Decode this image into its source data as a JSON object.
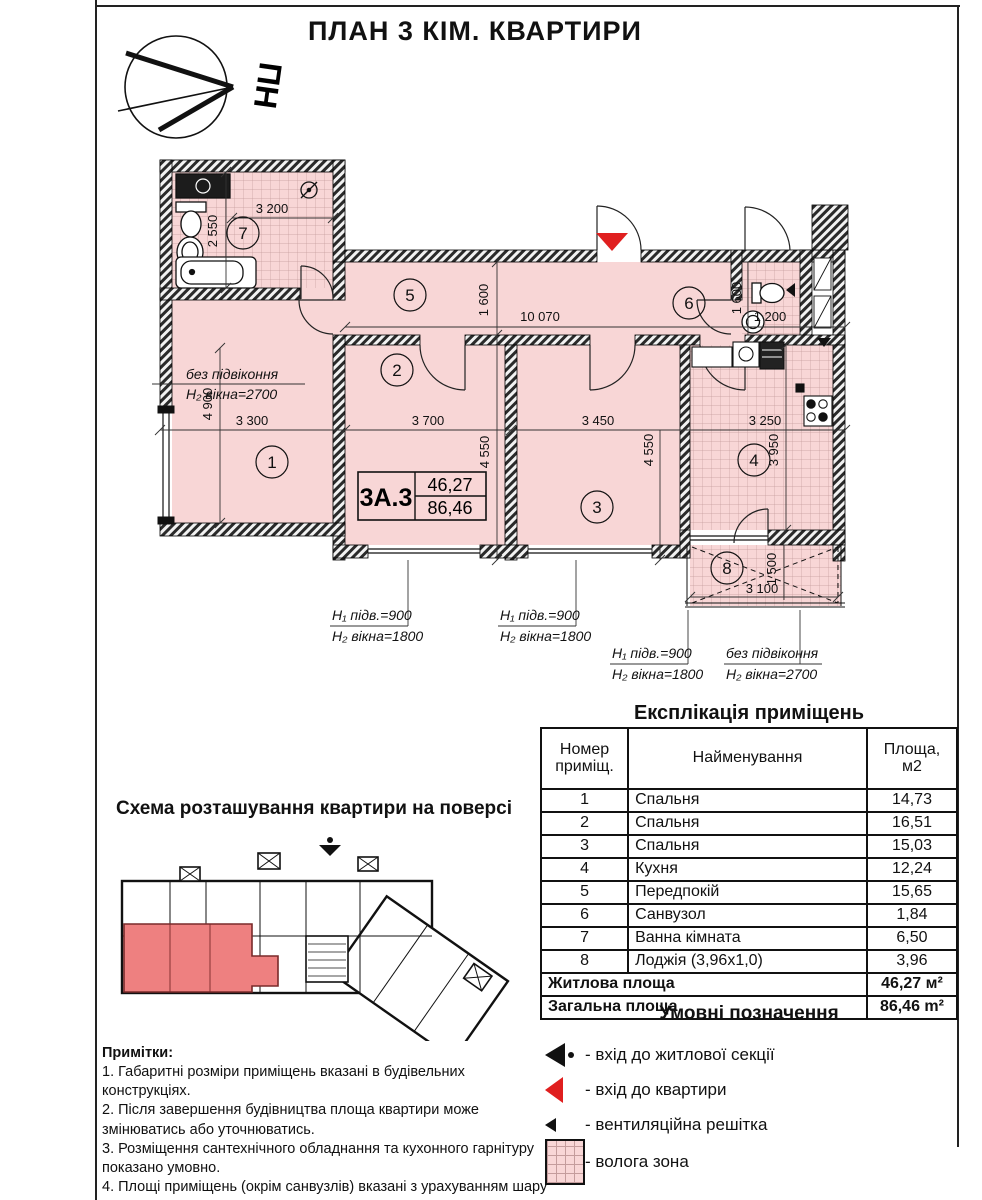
{
  "page": {
    "title": "ПЛАН 3 КІМ. КВАРТИРИ"
  },
  "compass": {
    "label": "ПН"
  },
  "plan": {
    "unit": {
      "code": "3А.3",
      "living": "46,27",
      "total": "86,46"
    },
    "rooms": [
      "1",
      "2",
      "3",
      "4",
      "5",
      "6",
      "7",
      "8"
    ],
    "dims": {
      "bath_w": "3 200",
      "bath_h": "2 550",
      "hall_len": "10 070",
      "hall_h": "1 600",
      "wc_h": "1 600",
      "wc_w": "1 200",
      "r1_w": "3 300",
      "r1_h": "4 900",
      "r2_w": "3 700",
      "r2_h": "4 550",
      "r3_w": "3 450",
      "r3_h": "4 550",
      "kit_w": "3 250",
      "kit_h": "3 950",
      "log_w": "3 100",
      "log_h": "1 500"
    },
    "win_notes": {
      "no_sill": "без підвіконня",
      "h2_2700": "H₂ вікна=2700",
      "h1_900": "H₁ підв.=900",
      "h2_1800": "H₂ вікна=1800"
    }
  },
  "scheme": {
    "title": "Схема розташування квартири на поверсі"
  },
  "explication": {
    "title": "Експлікація приміщень",
    "columns": [
      "Номер приміщ.",
      "Найменування",
      "Площа, м2"
    ],
    "rows": [
      [
        "1",
        "Спальня",
        "14,73"
      ],
      [
        "2",
        "Спальня",
        "16,51"
      ],
      [
        "3",
        "Спальня",
        "15,03"
      ],
      [
        "4",
        "Кухня",
        "12,24"
      ],
      [
        "5",
        "Передпокій",
        "15,65"
      ],
      [
        "6",
        "Санвузол",
        "1,84"
      ],
      [
        "7",
        "Ванна кімната",
        "6,50"
      ],
      [
        "8",
        "Лоджія (3,96x1,0)",
        "3,96"
      ]
    ],
    "summary": [
      {
        "label": "Житлова площа",
        "value": "46,27 м²"
      },
      {
        "label": "Загальна площа",
        "value": "86,46 m²"
      }
    ]
  },
  "legend": {
    "title": "Умовні позначення",
    "items": [
      {
        "icon": "section-entrance-icon",
        "label": "- вхід до житлової секції"
      },
      {
        "icon": "apartment-entrance-icon",
        "label": "- вхід до квартири"
      },
      {
        "icon": "vent-grille-icon",
        "label": "- вентиляційна решітка"
      },
      {
        "icon": "wet-zone-icon",
        "label": "- волога зона"
      }
    ]
  },
  "notes": {
    "title": "Примітки:",
    "lines": [
      "1. Габаритні розміри приміщень вказані в будівельних конструкціях.",
      "2. Після завершення будівництва площа квартири може змінюватись або уточнюватись.",
      "3. Розміщення сантехнічного обладнання та кухонного гарнітуру показано умовно.",
      "4. Площі приміщень (окрім санвузлів) вказані з урахуванням шару штукатурки.",
      "5. Площа квартир підрахована згідно ДБН В 2.2-15-2005."
    ]
  },
  "colors": {
    "accent_red": "#e01f1f",
    "wet_pink": "#f8d6d6"
  }
}
